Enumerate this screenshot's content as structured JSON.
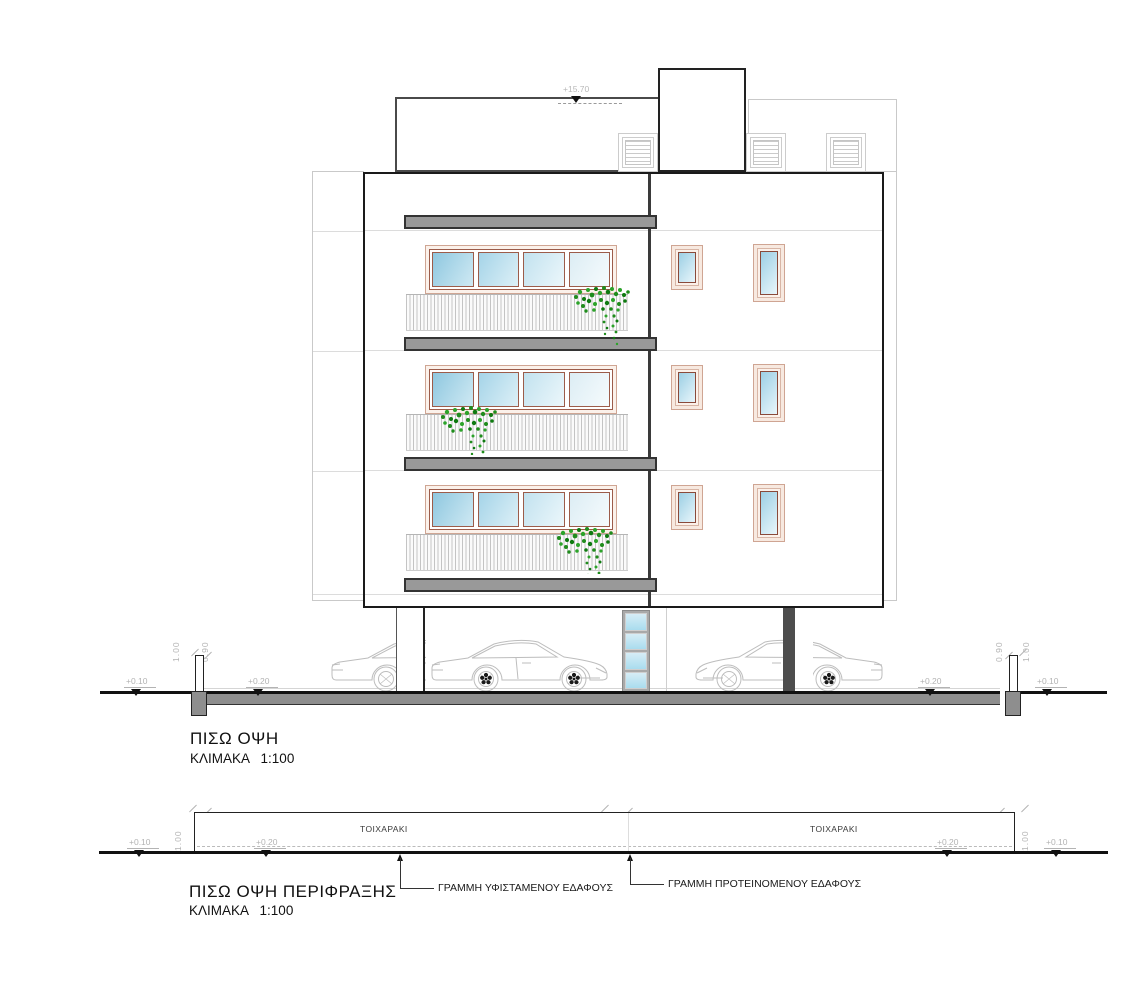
{
  "colors": {
    "outline": "#1a1a1a",
    "slab_gray": "#999999",
    "ground_slab_gray": "#8e8e8e",
    "window_frame_tan": "#cfa593",
    "window_frame_dark": "#8f5040",
    "glass_blue": "#9ecfe4",
    "plant_green": "#22901f",
    "faint_gray": "#c9c9c9",
    "dim_text_gray": "#b3b3b3"
  },
  "roof": {
    "level": "+15.70"
  },
  "main_elevation": {
    "title": "ΠΙΣΩ ΟΨΗ",
    "scale_label": "ΚΛΙΜΑΚΑ   1:100",
    "levels": {
      "far_left": "+0.10",
      "left": "+0.20",
      "right": "+0.20",
      "far_right": "+0.10"
    },
    "dims_left": [
      "1.00",
      "0.90"
    ],
    "dims_right": [
      "0.90",
      "1.00"
    ]
  },
  "fence_elevation": {
    "title": "ΠΙΣΩ ΟΨΗ ΠΕΡΙΦΡΑΞΗΣ",
    "scale_label": "ΚΛΙΜΑΚΑ   1:100",
    "wall_labels": [
      "ΤΟΙΧΑΡΑΚΙ",
      "ΤΟΙΧΑΡΑΚΙ"
    ],
    "levels": {
      "far_left": "+0.10",
      "left": "+0.20",
      "right": "+0.20",
      "far_right": "+0.10"
    },
    "dims_left": [
      "1.00",
      "0.90"
    ],
    "dims_middle": [
      "1.00",
      "0.90"
    ],
    "dims_right": [
      "0.90",
      "1.00"
    ],
    "callouts": [
      "ΓΡΑΜΜΗ ΥΦΙΣΤΑΜΕΝΟΥ ΕΔΑΦΟΥΣ",
      "ΓΡΑΜΜΗ ΠΡΟΤΕΙΝΟΜΕΝΟΥ ΕΔΑΦΟΥΣ"
    ]
  }
}
